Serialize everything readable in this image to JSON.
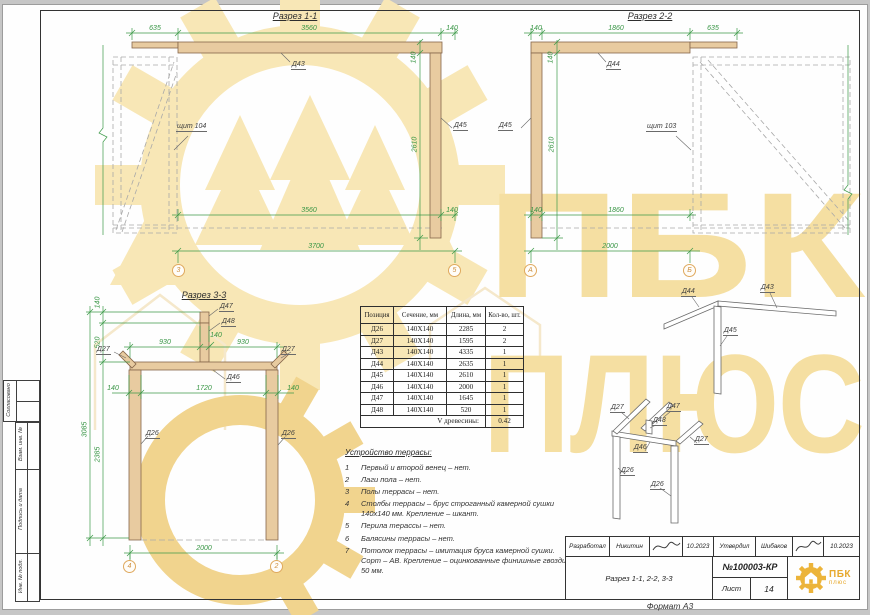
{
  "watermark": {
    "line1": "ПБК",
    "line2": "ПЛЮС"
  },
  "sec11": {
    "title": "Разрез 1-1",
    "axis_left": "3",
    "axis_right": "5",
    "dim_top_left": "635",
    "dim_top_mid": "3560",
    "dim_top_right": "140",
    "dim_beam_h": "140",
    "dim_height": "2610",
    "dim_bot_mid": "3560",
    "dim_bot_right": "140",
    "dim_total": "3700",
    "label_beam": "Д43",
    "label_post": "Д45",
    "label_panel": "щит 104"
  },
  "sec22": {
    "title": "Разрез 2-2",
    "axis_left": "А",
    "axis_right": "Б",
    "dim_top_left": "140",
    "dim_top_mid": "1860",
    "dim_top_right": "635",
    "dim_beam_h": "140",
    "dim_height": "2610",
    "dim_bot_left": "140",
    "dim_bot_mid": "1860",
    "dim_total": "2000",
    "label_beam": "Д44",
    "label_post": "Д45",
    "label_panel": "щит 103"
  },
  "sec33": {
    "title": "Разрез 3-3",
    "axis_left": "4",
    "axis_right": "2",
    "dim_cap_h": "140",
    "dim_post_h": "520",
    "dim_total_h": "3085",
    "dim_col_h": "2385",
    "dim_span_left": "930",
    "dim_post_w": "140",
    "dim_span_right": "930",
    "dim_col_left": "140",
    "dim_clear": "1720",
    "dim_col_right": "140",
    "dim_bottom": "2000",
    "label_cap": "Д47",
    "label_stub": "Д48",
    "label_beam": "Д46",
    "label_brace_left": "Д27",
    "label_brace_right": "Д27",
    "label_col_left": "Д26",
    "label_col_right": "Д26"
  },
  "iso": {
    "upper_left": "Д44",
    "upper_right": "Д43",
    "upper_post": "Д45",
    "lower_brace_left": "Д27",
    "lower_cap": "Д47",
    "lower_stub": "Д48",
    "lower_beam": "Д46",
    "lower_brace_right": "Д27",
    "lower_leg_left": "Д26",
    "lower_leg_right": "Д26"
  },
  "table": {
    "headers": [
      "Позиция",
      "Сечение, мм",
      "Длина, мм",
      "Кол-во, шт."
    ],
    "rows": [
      [
        "Д26",
        "140Х140",
        "2285",
        "2"
      ],
      [
        "Д27",
        "140Х140",
        "1595",
        "2"
      ],
      [
        "Д43",
        "140Х140",
        "4335",
        "1"
      ],
      [
        "Д44",
        "140Х140",
        "2635",
        "1"
      ],
      [
        "Д45",
        "140Х140",
        "2610",
        "1"
      ],
      [
        "Д46",
        "140Х140",
        "2000",
        "1"
      ],
      [
        "Д47",
        "140Х140",
        "1645",
        "1"
      ],
      [
        "Д48",
        "140Х140",
        "520",
        "1"
      ]
    ],
    "footer_label": "V древесины:",
    "footer_value": "0.42"
  },
  "notes": {
    "heading": "Устройство террасы:",
    "items": [
      {
        "num": "1",
        "text": "Первый и второй венец – нет."
      },
      {
        "num": "2",
        "text": "Лаги пола – нет."
      },
      {
        "num": "3",
        "text": "Полы террасы – нет."
      },
      {
        "num": "4",
        "text": "Столбы террасы – брус строганный камерной сушки 140х140 мм. Крепление – шкант."
      },
      {
        "num": "5",
        "text": "Перила терассы – нет."
      },
      {
        "num": "6",
        "text": "Балясины террасы – нет."
      },
      {
        "num": "7",
        "text": "Потолок террасы – имитация бруса камерной сушки. Сорт – АВ. Крепление – оцинкованные финишные гвозди 50 мм."
      }
    ]
  },
  "titleblock": {
    "developed_label": "Разработал",
    "developed_name": "Никитин",
    "developed_date": "10.2023",
    "approved_label": "Утвердил",
    "approved_name": "Шибаков",
    "approved_date": "10.2023",
    "doc_title": "Разрез 1-1, 2-2, 3-3",
    "doc_number": "№100003-КР",
    "sheet_label": "Лист",
    "sheet_number": "14",
    "logo_line1": "ПБК",
    "logo_line2": "плюс",
    "format_label": "Формат А3"
  },
  "side_stamp": {
    "agreed": "Согласовано",
    "exchange": "Взам. инв. №",
    "signdate": "Подпись и дата",
    "inventory": "Инв. № подл."
  }
}
